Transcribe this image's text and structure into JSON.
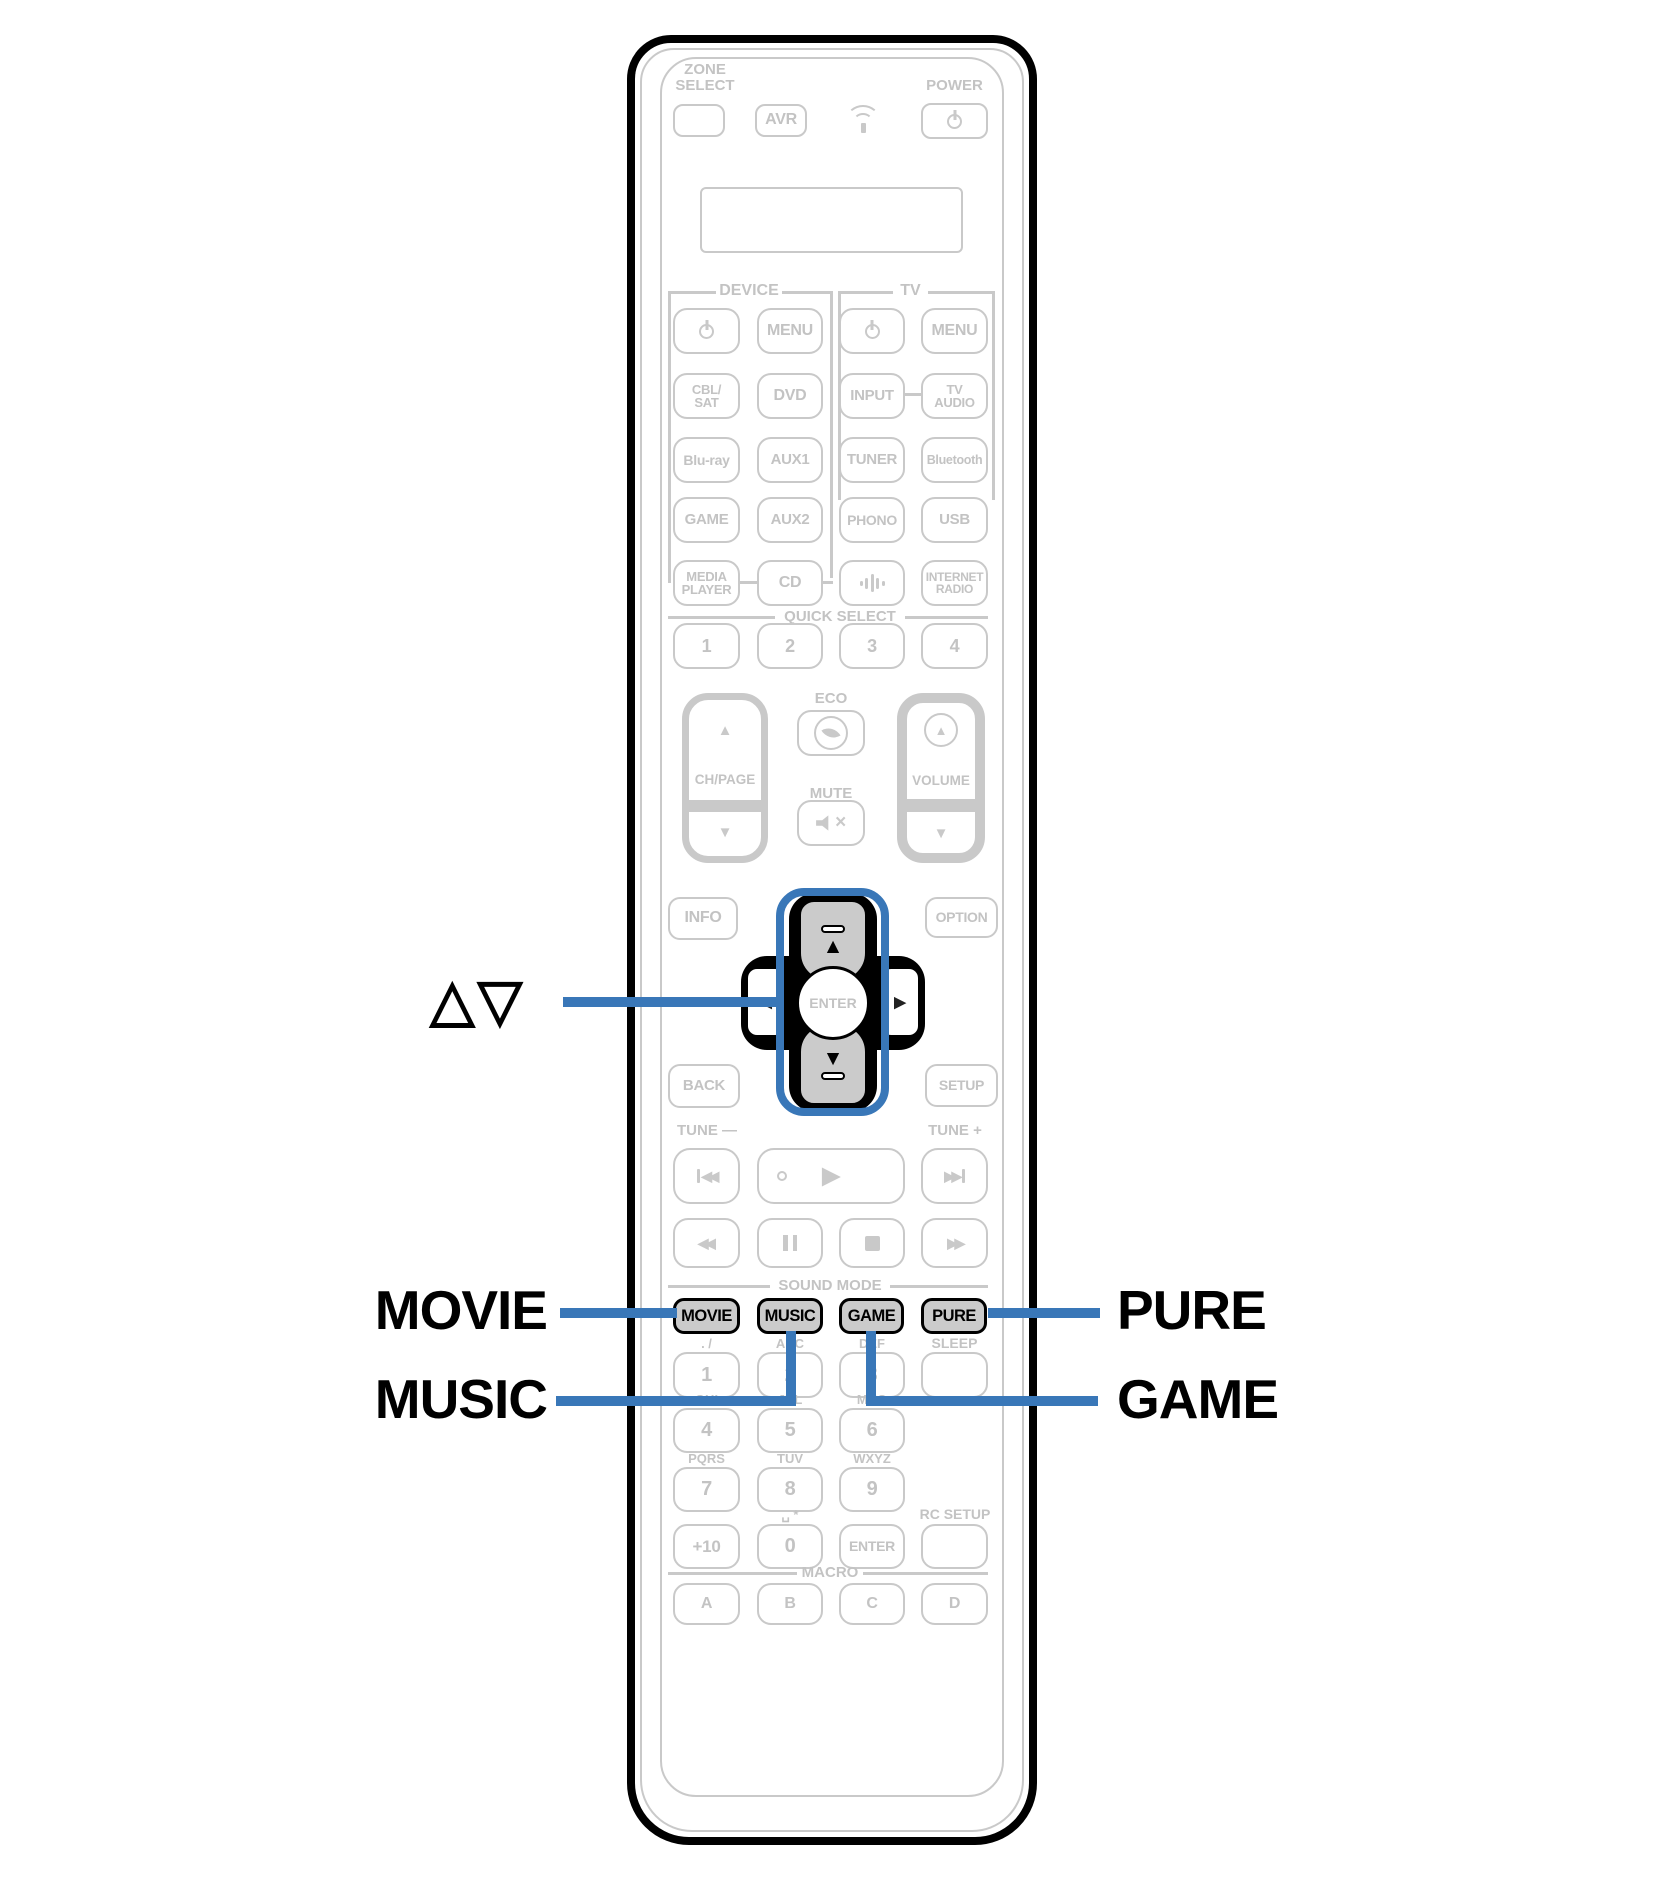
{
  "colors": {
    "accent_blue": "#3977b8",
    "outline_gray": "#c9c9c9",
    "text_gray": "#c3c3c3",
    "highlight_key_fill": "#cbcbcb",
    "black": "#000000"
  },
  "callouts": {
    "cursor": {
      "label": "△▽"
    },
    "movie": {
      "label": "MOVIE"
    },
    "music": {
      "label": "MUSIC"
    },
    "pure": {
      "label": "PURE"
    },
    "game": {
      "label": "GAME"
    }
  },
  "remote": {
    "zone_select": "ZONE\nSELECT",
    "avr": "AVR",
    "power_label": "POWER",
    "sections": {
      "device": "DEVICE",
      "tv": "TV",
      "quick_select": "QUICK SELECT",
      "sound_mode": "SOUND MODE",
      "macro": "MACRO"
    },
    "grid": {
      "device_menu": "MENU",
      "tv_menu": "MENU",
      "cbl_sat": "CBL/\nSAT",
      "dvd": "DVD",
      "input": "INPUT",
      "tv_audio": "TV\nAUDIO",
      "bluray": "Blu-ray",
      "aux1": "AUX1",
      "tuner": "TUNER",
      "bluetooth": "Bluetooth",
      "game": "GAME",
      "aux2": "AUX2",
      "phono": "PHONO",
      "usb": "USB",
      "media_player": "MEDIA\nPLAYER",
      "cd": "CD",
      "internet_radio": "INTERNET\nRADIO"
    },
    "quick_select_buttons": [
      "1",
      "2",
      "3",
      "4"
    ],
    "eco": "ECO",
    "mute": "MUTE",
    "ch_page": "CH/PAGE",
    "volume": "VOLUME",
    "info": "INFO",
    "option": "OPTION",
    "back": "BACK",
    "setup": "SETUP",
    "enter": "ENTER",
    "tune_minus": "TUNE —",
    "tune_plus": "TUNE +",
    "sound_mode_buttons": [
      "MOVIE",
      "MUSIC",
      "GAME",
      "PURE"
    ],
    "sleep": "SLEEP",
    "rc_setup": "RC SETUP",
    "keypad": {
      "digits": [
        "1",
        "2",
        "3",
        "4",
        "5",
        "6",
        "7",
        "8",
        "9"
      ],
      "letters": [
        ". /",
        "ABC",
        "DEF",
        "GHI",
        "JKL",
        "MNO",
        "PQRS",
        "TUV",
        "WXYZ"
      ],
      "plus_ten": "+10",
      "zero": "0",
      "zero_label": "␣ *",
      "enter": "ENTER"
    },
    "macro_buttons": [
      "A",
      "B",
      "C",
      "D"
    ]
  },
  "icons": {
    "ch_up": "▲",
    "ch_down": "▼",
    "vol_up": "▲",
    "vol_down": "▼",
    "cursor_up": "▲",
    "cursor_down": "▼",
    "cursor_left": "◀",
    "cursor_right": "▶",
    "play": "▶",
    "rewind": "◀◀",
    "fast_forward": "▶▶",
    "skip_back": "◀◀",
    "skip_forward": "▶▶",
    "mute_x": "×"
  }
}
